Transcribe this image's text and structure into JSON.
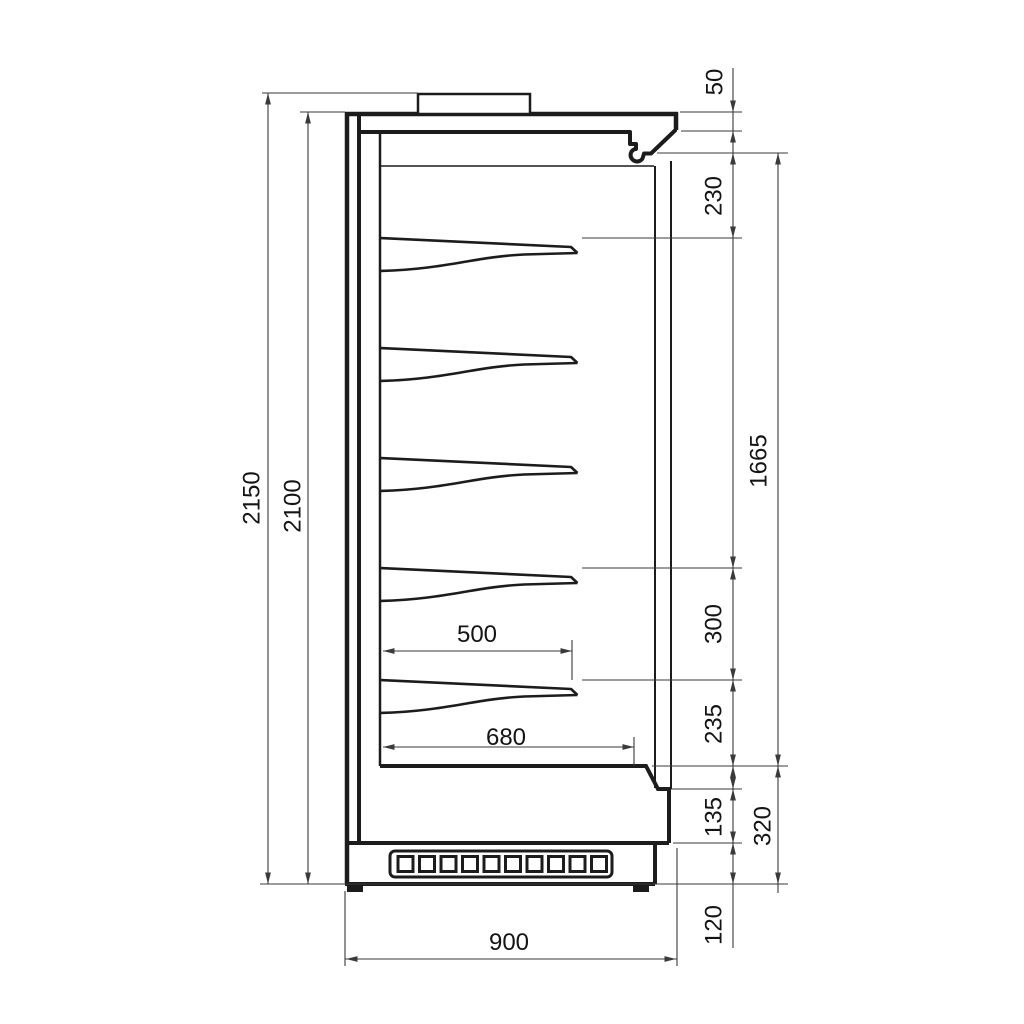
{
  "drawing": {
    "type": "technical-side-section",
    "shelf_count": 5,
    "colors": {
      "outline": "#1c1c1c",
      "dimension": "#3a3a3a",
      "background": "#ffffff"
    },
    "labels": {
      "overall_height": "2150",
      "body_height": "2100",
      "top_unit_height": "50",
      "canopy_to_top_shelf": "230",
      "display_opening_height": "1665",
      "shelf_spacing": "300",
      "bottom_shelf_to_deck": "235",
      "front_lower_panel": "135",
      "base_section_height": "320",
      "plinth_height": "120",
      "shelf_depth": "500",
      "deck_depth": "680",
      "overall_depth": "900"
    }
  }
}
